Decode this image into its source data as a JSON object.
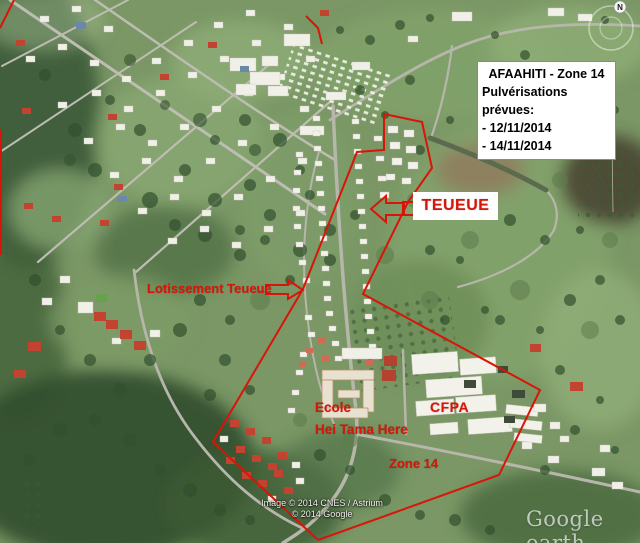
{
  "info_box": {
    "title": "AFAAHITI - Zone 14",
    "subtitle": "Pulvérisations prévues:",
    "dates": [
      "- 12/11/2014",
      "- 14/11/2014"
    ]
  },
  "labels": {
    "teueue": "TEUEUE",
    "lotissement": "Lotissement Teueue",
    "ecole_line1": "Ecole",
    "ecole_line2": "Hei Tama Here",
    "cfpa": "CFPA",
    "zone": "Zone 14"
  },
  "attribution": {
    "line1": "Image © 2014 CNES / Astrium",
    "line2": "© 2014 Google"
  },
  "watermark": {
    "text": "Google earth"
  },
  "compass": {
    "north_label": "N"
  },
  "colors": {
    "annotation_red": "#d81508",
    "info_text": "#000000",
    "label_box_bg": "#ffffff"
  }
}
